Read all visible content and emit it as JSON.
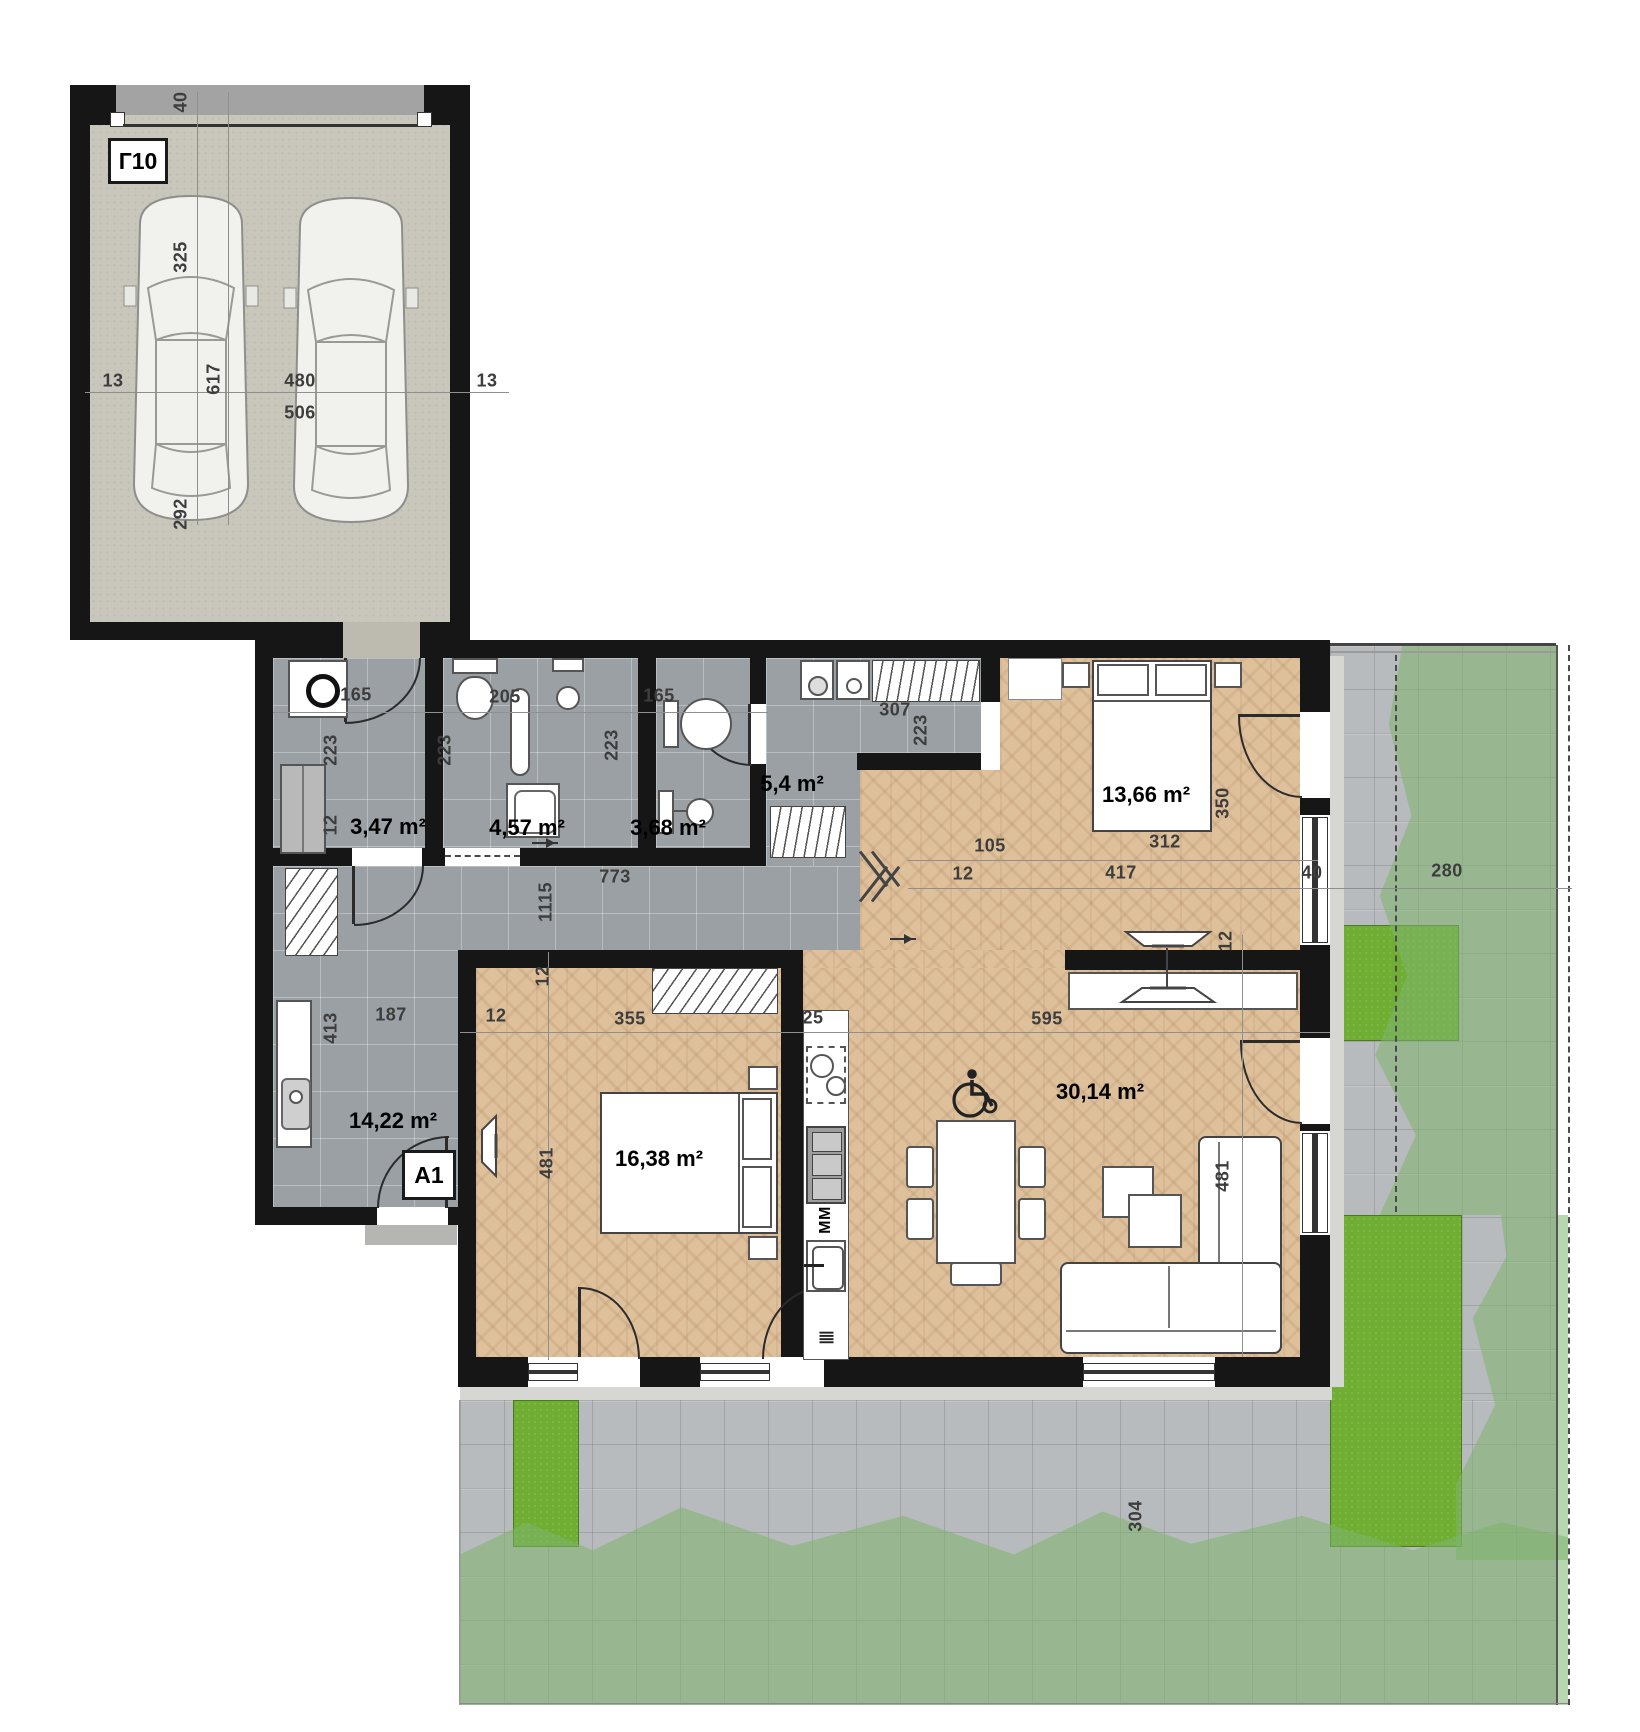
{
  "units": {
    "garage": "Г10",
    "apartment": "A1"
  },
  "areas": {
    "laundry": "3,47 m²",
    "bathroom": "4,57 m²",
    "wc": "3,68 m²",
    "closet": "5,4 m²",
    "bedroom_small": "13,66 m²",
    "hallway": "14,22 m²",
    "bedroom_large": "16,38 m²",
    "living": "30,14 m²"
  },
  "dims": {
    "g_door": "40",
    "g_car_front": "325",
    "g_car_len": "617",
    "g_wall_l": "13",
    "g_clear": "480",
    "g_width": "506",
    "g_wall_r": "13",
    "g_car_rear": "292",
    "laundry_w": "165",
    "laundry_d": "223",
    "laundry_wall": "12",
    "bath_w": "205",
    "bath_d": "223",
    "wc_w": "165",
    "wc_d": "223",
    "closet_w": "307",
    "closet_d": "223",
    "hall_len": "773",
    "hall_clear": "1115",
    "hall_w": "187",
    "hall_wall": "12",
    "hall_d": "413",
    "b13_off": "105",
    "b13_bed": "312",
    "b13_d": "350",
    "b13_wall": "12",
    "b13_w": "417",
    "b13_ext": "40",
    "b13_media": "12",
    "b16_w": "355",
    "b16_d": "481",
    "b16_wall": "12",
    "kitchen_w": "25",
    "living_w": "595",
    "living_d": "481",
    "terr_w": "280",
    "terr_d": "304",
    "terr_wall": "40"
  },
  "kitchen": {
    "microwave": "MM"
  },
  "colors": {
    "wall": "#161616",
    "tile_floor": "#9aa0a4",
    "parquet": "#dec09b",
    "paving": "#b8bbbd",
    "grass": "#6fae33",
    "garden_overlay": "#7db46e",
    "garage_floor": "#c9c6bb"
  }
}
